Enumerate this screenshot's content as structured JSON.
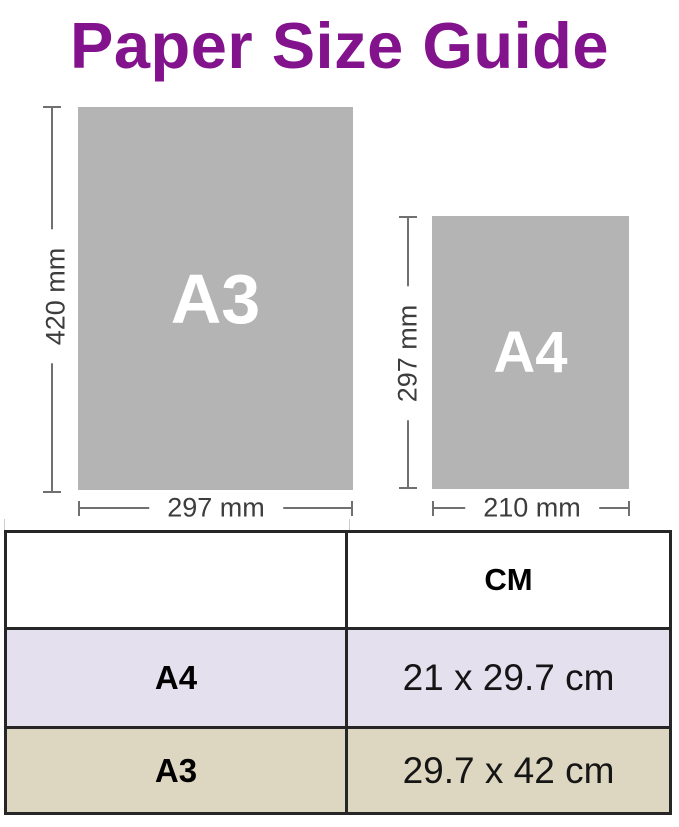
{
  "title": "Paper Size Guide",
  "colors": {
    "title_purple": "#83128d",
    "paper_gray": "#b4b4b4",
    "paper_label_white": "#ffffff",
    "dimension_line_gray": "#707070",
    "dimension_text_gray": "#3d3d3d",
    "table_row_a4_bg": "#e4e0ee",
    "table_row_a3_bg": "#ddd7c2",
    "table_border": "#262626"
  },
  "diagram": {
    "a3": {
      "label": "A3",
      "height": "420 mm",
      "width": "297 mm"
    },
    "a4": {
      "label": "A4",
      "height": "297 mm",
      "width": "210 mm"
    }
  },
  "table": {
    "header": {
      "size": "",
      "cm": "CM"
    },
    "rows": [
      {
        "size": "A4",
        "cm": "21 x 29.7 cm"
      },
      {
        "size": "A3",
        "cm": "29.7 x 42 cm"
      }
    ]
  }
}
